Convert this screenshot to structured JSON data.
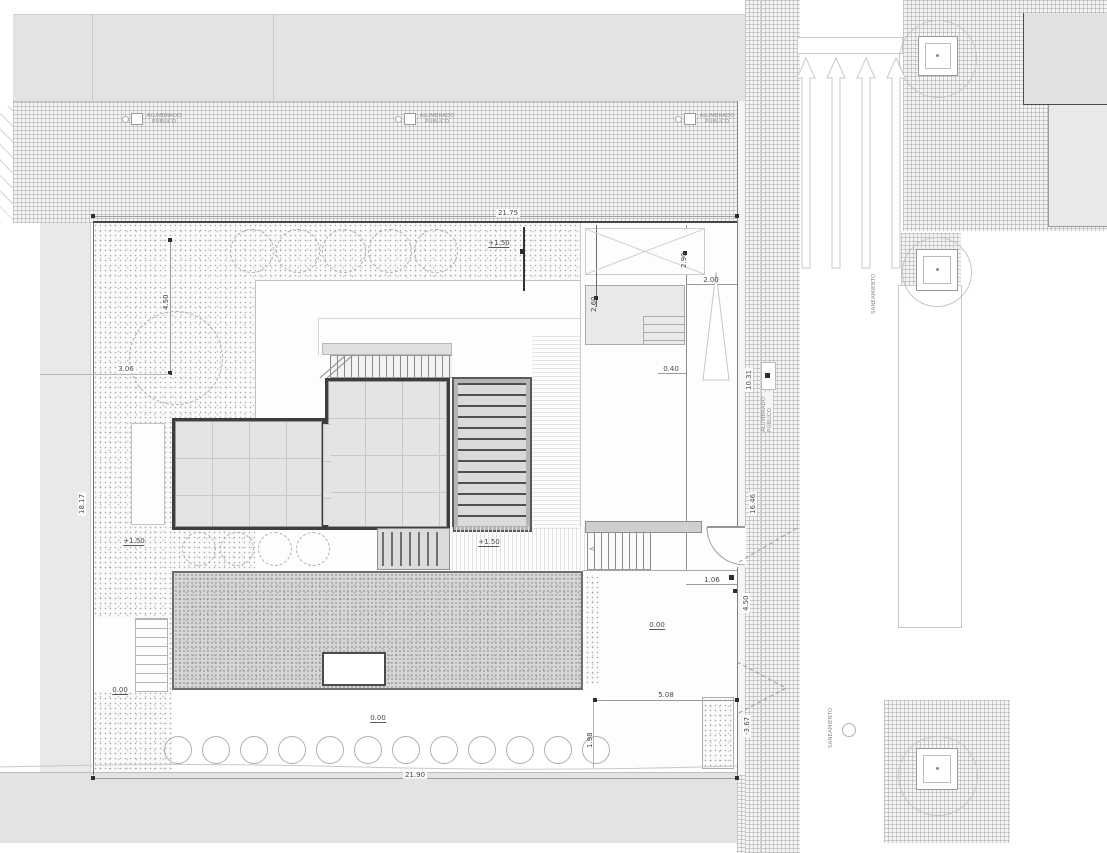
{
  "labels": {
    "public_lighting": "ALUMBRADO PÚBLICO",
    "sewerage": "SANEAMIENTO"
  },
  "dimensions": {
    "plot_width_top": "21.75",
    "plot_width_bottom": "21.90",
    "plot_depth_left": "18.17",
    "street_upper": "10.31",
    "street_middle": "16.46",
    "street_entry": "4.50",
    "street_lower": "-3.67",
    "entry_gate": "1.06",
    "courtyard_width": "5.08",
    "courtyard_edge": "1.98",
    "side_setback": "2.00",
    "side_offset": "0.40",
    "garden_tree_line": "4.50",
    "garden_left_line": "3.06",
    "stair_run_a": "2.90",
    "stair_run_b": "2.60"
  },
  "levels": {
    "garden_upper": "+1.50",
    "deck_mid": "+1.50",
    "garden_west": "+1.50",
    "courtyard": "0.00",
    "path": "0.00",
    "stair_foot": "0.00"
  }
}
